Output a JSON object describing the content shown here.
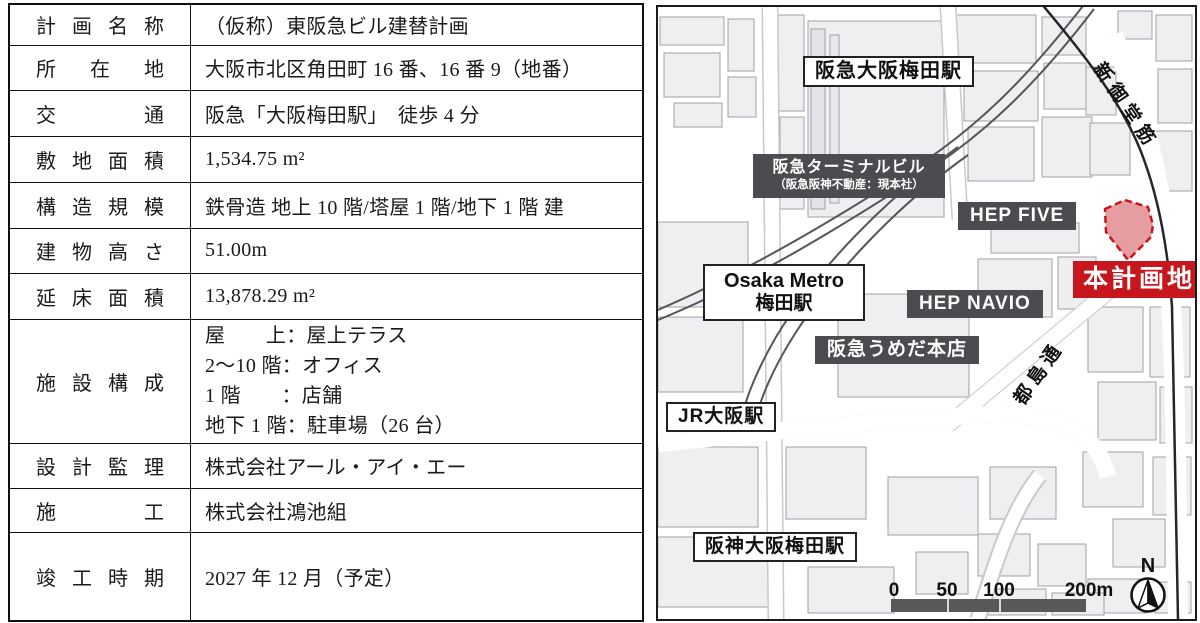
{
  "table": {
    "rows": [
      {
        "label": "計画名称",
        "value": "（仮称）東阪急ビル建替計画"
      },
      {
        "label": "所在地",
        "value": "大阪市北区角田町 16 番、16 番 9（地番）"
      },
      {
        "label": "交通",
        "value": "阪急「大阪梅田駅」　徒歩 4 分"
      },
      {
        "label": "敷地面積",
        "value": "1,534.75 m²"
      },
      {
        "label": "構造規模",
        "value": "鉄骨造 地上 10 階/塔屋 1 階/地下 1 階 建"
      },
      {
        "label": "建物高さ",
        "value": "51.00m"
      },
      {
        "label": "延床面積",
        "value": "13,878.29 m²"
      },
      {
        "label": "施設構成",
        "lines": [
          "屋　　上：屋上テラス",
          "2～10 階：オフィス",
          "1 階　　：店舗",
          "地下 1 階：駐車場（26 台）"
        ]
      },
      {
        "label": "設計監理",
        "value": "株式会社アール・アイ・エー"
      },
      {
        "label": "施工",
        "value": "株式会社鴻池組"
      },
      {
        "label": "竣工時期",
        "value": "2027 年 12 月（予定）"
      }
    ]
  },
  "map": {
    "labels": {
      "hankyu_osaka_umeda_station": "阪急大阪梅田駅",
      "terminal_building_line1": "阪急ターミナルビル",
      "terminal_building_line2": "（阪急阪神不動産：現本社）",
      "hep_five": "HEP FIVE",
      "osaka_metro_line1": "Osaka Metro",
      "osaka_metro_line2": "梅田駅",
      "hep_navio": "HEP NAVIO",
      "hankyu_umeda_main_store": "阪急うめだ本店",
      "project_site": "本計画地",
      "jr_osaka_station": "JR大阪駅",
      "hanshin_osaka_umeda_station": "阪神大阪梅田駅",
      "road_shin_midosuji": "新御堂筋",
      "road_miyakojima_dori": "都島通",
      "north_mark": "N"
    },
    "scale": {
      "ticks": [
        "0",
        "50",
        "100",
        "200m"
      ]
    },
    "colors": {
      "site_red": "#c7161d",
      "label_dark_bg": "#4b4b50",
      "building_fill": "#efeff1"
    }
  }
}
